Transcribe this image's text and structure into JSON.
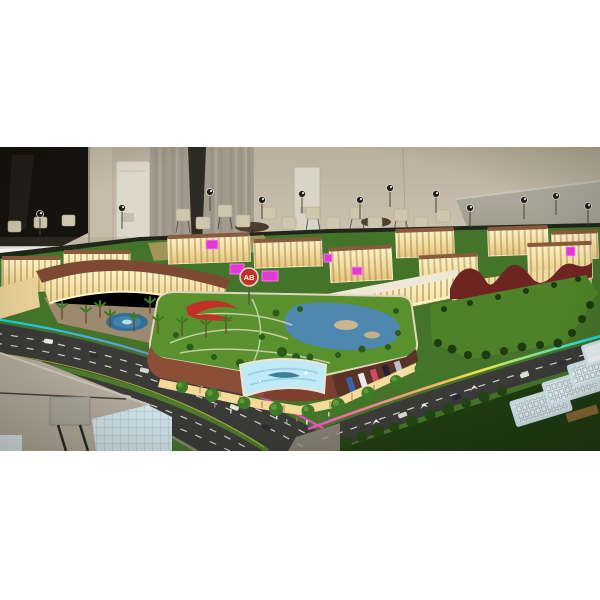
{
  "photo": {
    "description": "Illuminated architectural scale model of a shopping mall complex displayed in a showroom with chairs, curtains and a leaning grey display board behind it",
    "mall_logo": "AB"
  },
  "colors": {
    "wall": "#c1b8a4",
    "window_dark": "#16130f",
    "curtain": "#a29b8d",
    "board_grey": "#a8a597",
    "lawn": "#44742a",
    "roof_lawn": "#5a912f",
    "east_lawn": "#4d8228",
    "water": "#4e88b0",
    "fountain_blue": "#3f84ad",
    "asphalt": "#3a3b38",
    "warm_glow": "#f7e4a8",
    "brick": "#8a4f36",
    "brick_dark": "#5c3126",
    "maroon_roof": "#6e2420",
    "magenta_led": "#e33ad6",
    "billboard_blue": "#c2e9f6",
    "slab_white": "#f6fbfd",
    "sculpture_red": "#c03226",
    "foreground_roof": "#b4ac9d",
    "neon_cyan": "#00e5ff",
    "neon_magenta": "#ff3bd4",
    "neon_yellow": "#ffe34a"
  }
}
